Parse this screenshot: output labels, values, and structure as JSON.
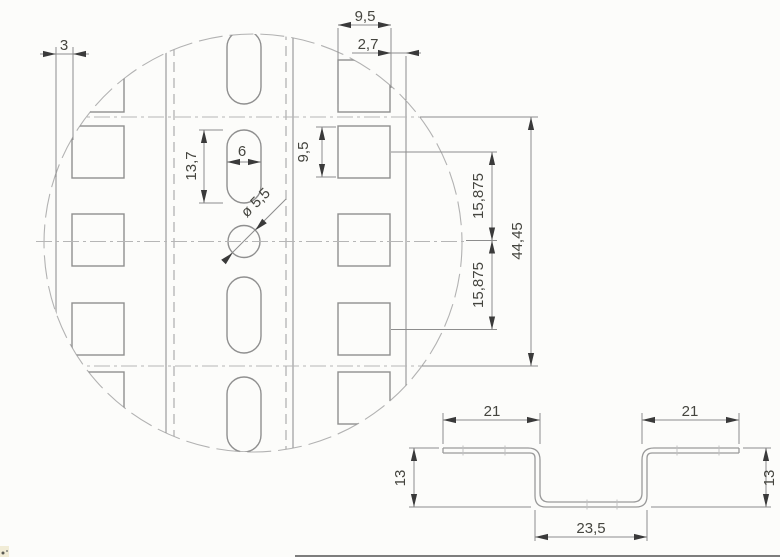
{
  "detail": {
    "edge_margin": "3",
    "square_size_top": "9,5",
    "edge_offset": "2,7",
    "slot_length": "13,7",
    "slot_width": "6",
    "square_size_side": "9,5",
    "hole_diameter": "ø 5,5",
    "row_pitch_upper": "15,875",
    "row_pitch_lower": "15,875",
    "pattern_span": "44,45"
  },
  "section": {
    "flange_left": "21",
    "flange_right": "21",
    "depth_left": "13",
    "depth_right": "13",
    "channel_width": "23,5"
  }
}
